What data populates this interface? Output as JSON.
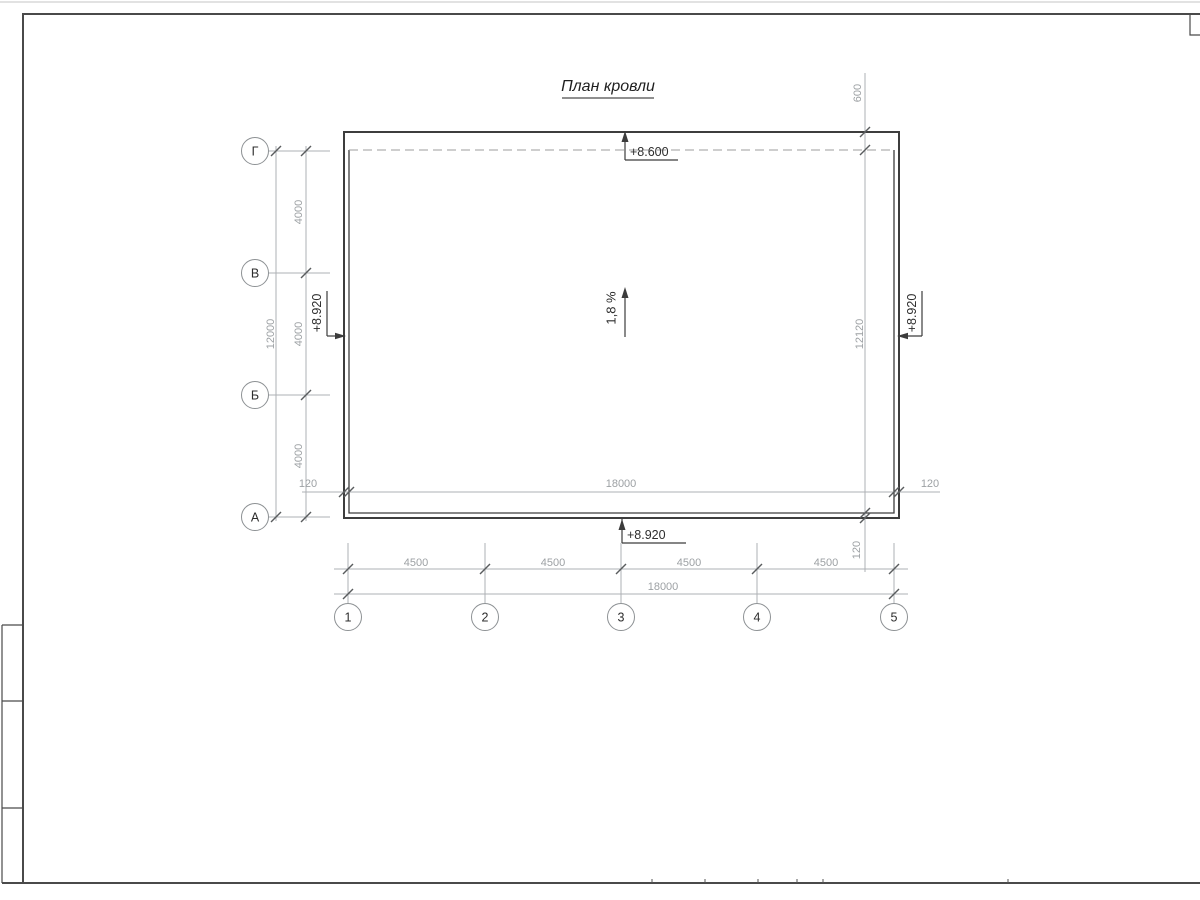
{
  "sheet": {
    "title": "План кровли"
  },
  "colors": {
    "line": "#3d3d3d",
    "dim_line": "#aeb1b4",
    "dim_text": "#9da1a4",
    "text": "#2d2d2d"
  },
  "axes": {
    "rows": [
      "Г",
      "В",
      "Б",
      "А"
    ],
    "cols": [
      "1",
      "2",
      "3",
      "4",
      "5"
    ]
  },
  "dims": {
    "left": {
      "segments": [
        "4000",
        "4000",
        "4000"
      ],
      "total": "12000"
    },
    "bottom": {
      "segments": [
        "4500",
        "4500",
        "4500",
        "4500"
      ],
      "total": "18000"
    },
    "inner": {
      "left_overhang": "120",
      "width": "18000",
      "right_overhang": "120"
    },
    "right": {
      "top_overhang": "600",
      "total": "12120",
      "bottom_overhang": "120"
    }
  },
  "elevations": {
    "top": "+8.600",
    "bottom": "+8.920",
    "left": "+8.920",
    "right": "+8.920"
  },
  "slope": {
    "label": "1,8 %"
  }
}
